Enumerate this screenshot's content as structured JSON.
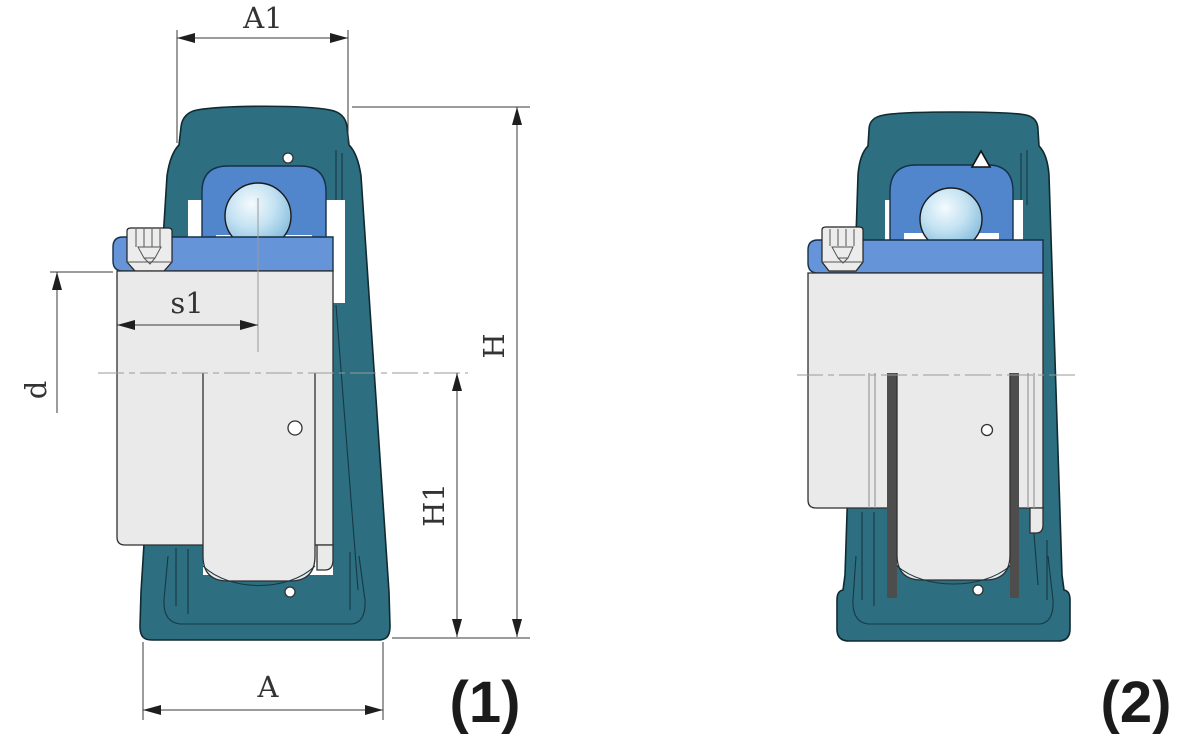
{
  "drawing": {
    "captions": {
      "fig1": "(1)",
      "fig2": "(2)"
    },
    "dims": {
      "a1": "A1",
      "h": "H",
      "h1": "H1",
      "s1": "s1",
      "d": "d",
      "a": "A"
    }
  },
  "colors": {
    "housing_teal": "#2d6e80",
    "bearing_blue": "#5186cc",
    "collar_blue": "#6594d8",
    "ball_blue": "#9ccbe6",
    "seal_green": "#2f8a34",
    "seal_yellow": "#d9e766",
    "shaft_gray": "#eaeaea",
    "dimension_line": "#3a3a3a"
  }
}
